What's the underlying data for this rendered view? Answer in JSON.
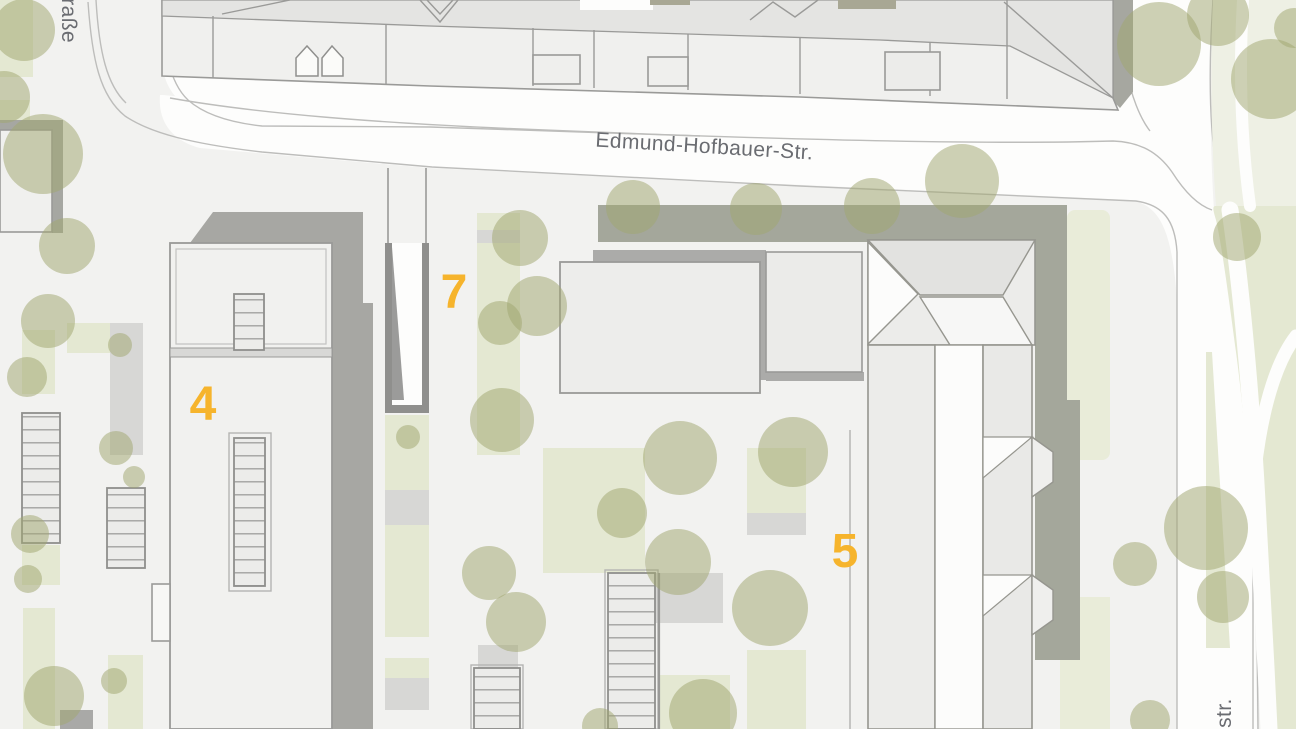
{
  "map": {
    "type": "site-plan",
    "labels": {
      "street_main": "Edmund-Hofbauer-Str.",
      "street_left_partial": "traße",
      "street_right_partial": "nstr.",
      "building_4": "4",
      "building_5": "5",
      "building_7": "7"
    },
    "colors": {
      "background": "#f2f2f0",
      "street": "#fdfdfc",
      "curb": "#bdbdbb",
      "lawn": "#e4e8d2",
      "lawn_pale": "#eef0e4",
      "tree": "#a2a772",
      "building_fill": "#f0f0ee",
      "roof_shade": "#e4e4e2",
      "bright_roof": "#fcfcfb",
      "outline": "#9a9a98",
      "shadow": "#a6a7a0",
      "paving": "#d7d7d5",
      "label_yellow": "#f6b42c",
      "street_text": "#6a6c71"
    }
  }
}
